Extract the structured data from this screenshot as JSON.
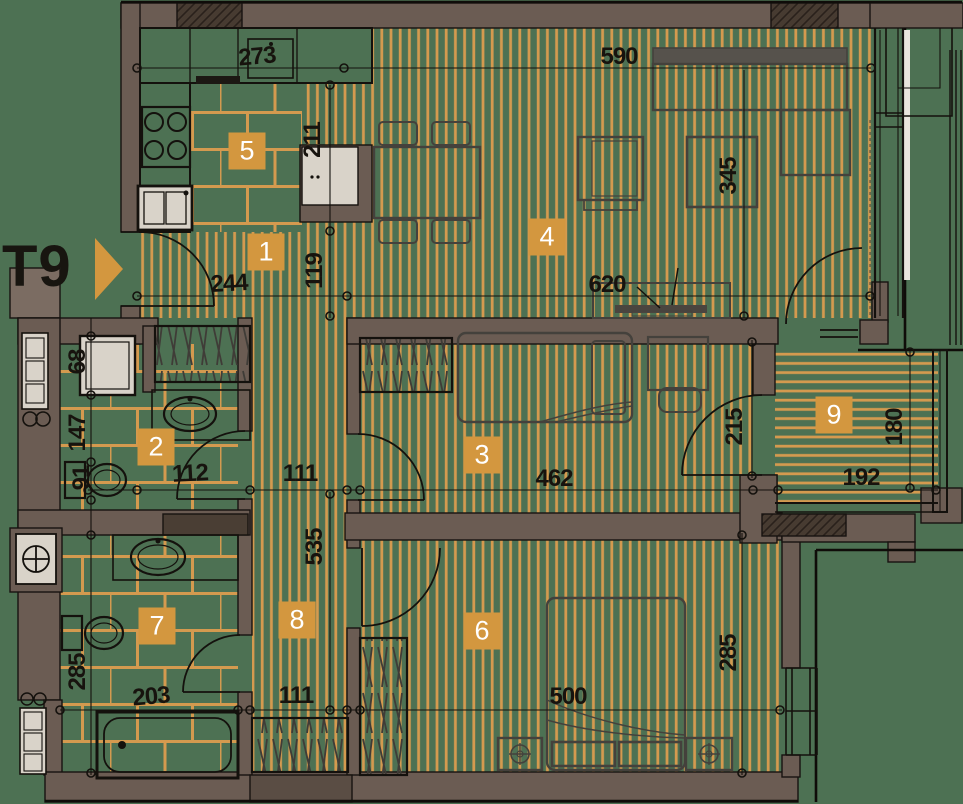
{
  "unit": {
    "label": "T9"
  },
  "rooms": {
    "r1": "1",
    "r2": "2",
    "r3": "3",
    "r4": "4",
    "r5": "5",
    "r6": "6",
    "r7": "7",
    "r8": "8",
    "r9": "9"
  },
  "dims": {
    "d273": "273",
    "d590": "590",
    "d211": "211",
    "d345": "345",
    "d244": "244",
    "d620": "620",
    "d119": "119",
    "d68": "68",
    "d147": "147",
    "d91": "91",
    "d112": "112",
    "d111a": "111",
    "d462": "462",
    "d215": "215",
    "d180": "180",
    "d192": "192",
    "d535": "535",
    "d203": "203",
    "d111b": "111",
    "d500": "500",
    "d285a": "285",
    "d285b": "285"
  },
  "colors": {
    "floor_green": "#4d7153",
    "stripe_orange": "#d49a4f",
    "wall_brown": "#6b5c53",
    "wall_dark": "#473b31",
    "badge_orange": "#d3973f",
    "line_black": "#14110d",
    "fixture_white": "#d9d3c9"
  }
}
